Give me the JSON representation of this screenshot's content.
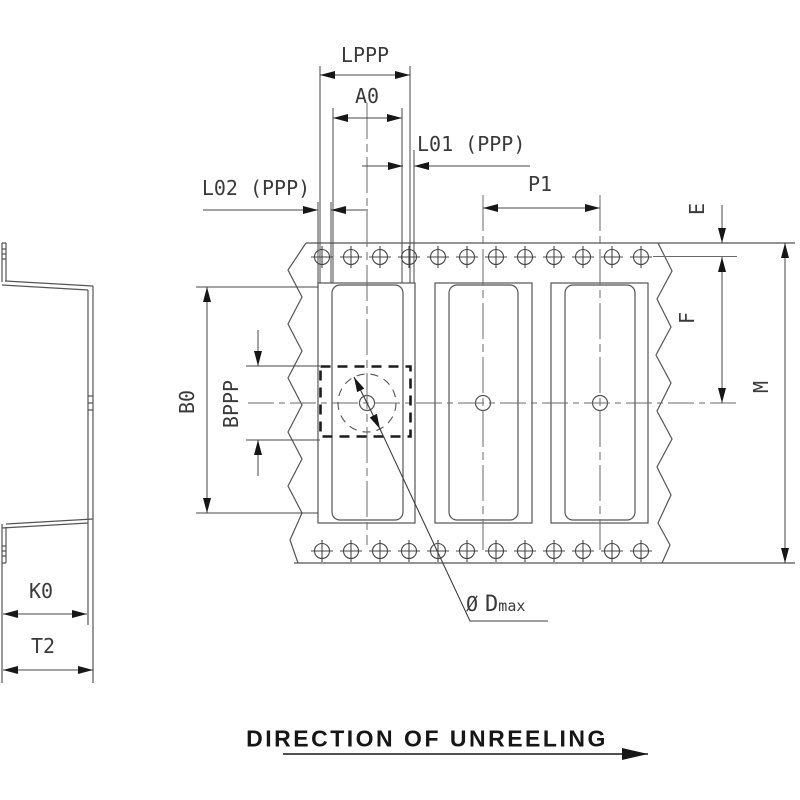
{
  "drawing": {
    "title": "carrier-tape-dimension-drawing",
    "top_dimensions": {
      "lppp": "LPPP",
      "a0": "A0",
      "l01": "L01 (PPP)",
      "l02": "L02 (PPP)",
      "p1": "P1"
    },
    "right_dimensions": {
      "e": "E",
      "f": "F",
      "m": "M"
    },
    "left_dimensions": {
      "b0": "B0",
      "bppp": "BPPP"
    },
    "side_view_dimensions": {
      "k0": "K0",
      "t2": "T2"
    },
    "annotation": {
      "diameter_symbol": "Ø",
      "diameter_name": "D",
      "diameter_subscript": "max"
    },
    "footer": {
      "direction_label": "DIRECTION OF UNREELING"
    },
    "colors": {
      "line": "#555555",
      "dimension_line": "#474747",
      "arrow": "#161616",
      "text": "#3a3a3a",
      "background": "#ffffff"
    }
  }
}
